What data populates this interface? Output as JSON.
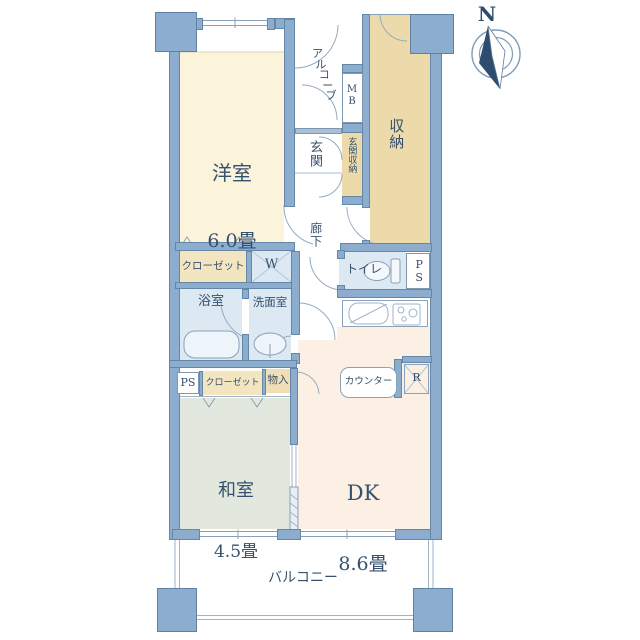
{
  "compass": {
    "north_label": "N"
  },
  "rooms": {
    "western_room": {
      "name": "洋室",
      "size": "6.0畳"
    },
    "japanese_room": {
      "name": "和室",
      "size": "4.5畳"
    },
    "dining_kitchen": {
      "name": "DK",
      "size": "8.6畳"
    },
    "storage": "収納",
    "entrance": "玄関",
    "entrance_storage": "玄関収納",
    "hallway": "廊下",
    "toilet": "トイレ",
    "bathroom": "浴室",
    "washroom": "洗面室",
    "balcony": "バルコニー",
    "alcove": "アルコーブ",
    "closet_upper": "クローゼット",
    "closet_lower": "クローゼット",
    "storage_small": "物入",
    "counter": "カウンター",
    "meter_box": "MB",
    "pipe_space_left": "PS",
    "pipe_space_right": "PS",
    "washer": "W",
    "refrigerator": "R"
  },
  "colors": {
    "wall": "#8cadce",
    "western_room": "#fcf4da",
    "storage_tan": "#ecdaab",
    "closet_tan": "#f4e5c1",
    "wet_blue": "#dce9f3",
    "japanese_room": "#e2e8de",
    "dining_kitchen": "#fcf0e4",
    "text": "#35516e"
  }
}
